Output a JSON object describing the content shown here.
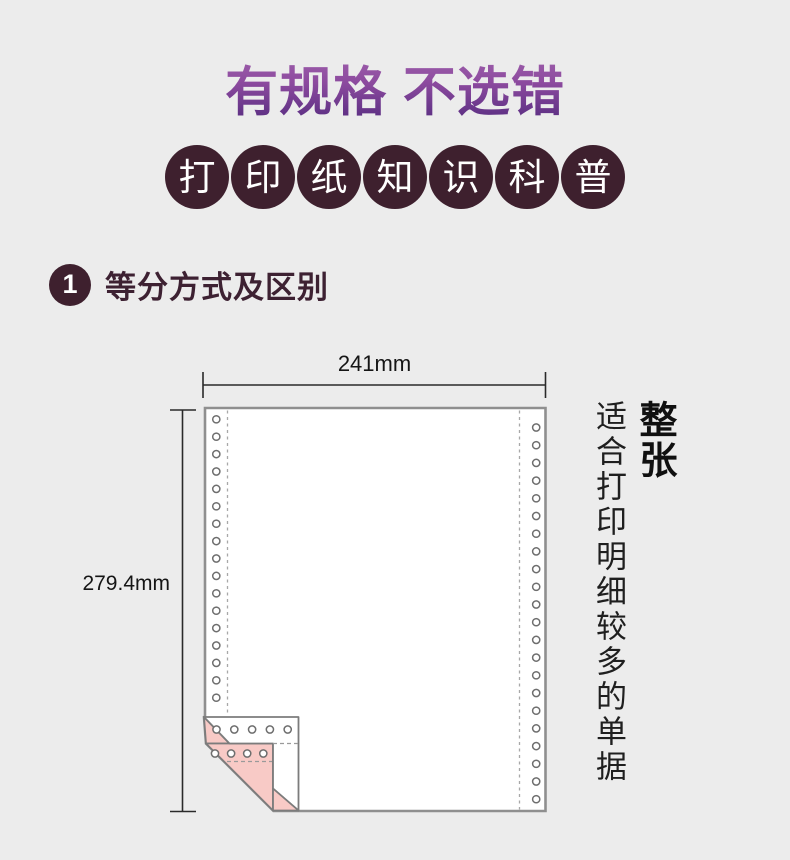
{
  "colors": {
    "background": "#ececec",
    "title_gradient_top": "#a264ae",
    "title_gradient_bottom": "#532a7e",
    "badge_background": "#3e202e",
    "section_text": "#3d2132",
    "paper_border": "#8f8f8f",
    "ply_pink": "#f8cac6"
  },
  "header": {
    "title": "有规格 不选错",
    "badges": [
      "打",
      "印",
      "纸",
      "知",
      "识",
      "科",
      "普"
    ]
  },
  "section": {
    "number": "1",
    "title": "等分方式及区别"
  },
  "diagram": {
    "width_label": "241mm",
    "height_label": "279.4mm"
  },
  "annotation": {
    "headline": "整张",
    "description": "适合打印明细较多的单据"
  }
}
